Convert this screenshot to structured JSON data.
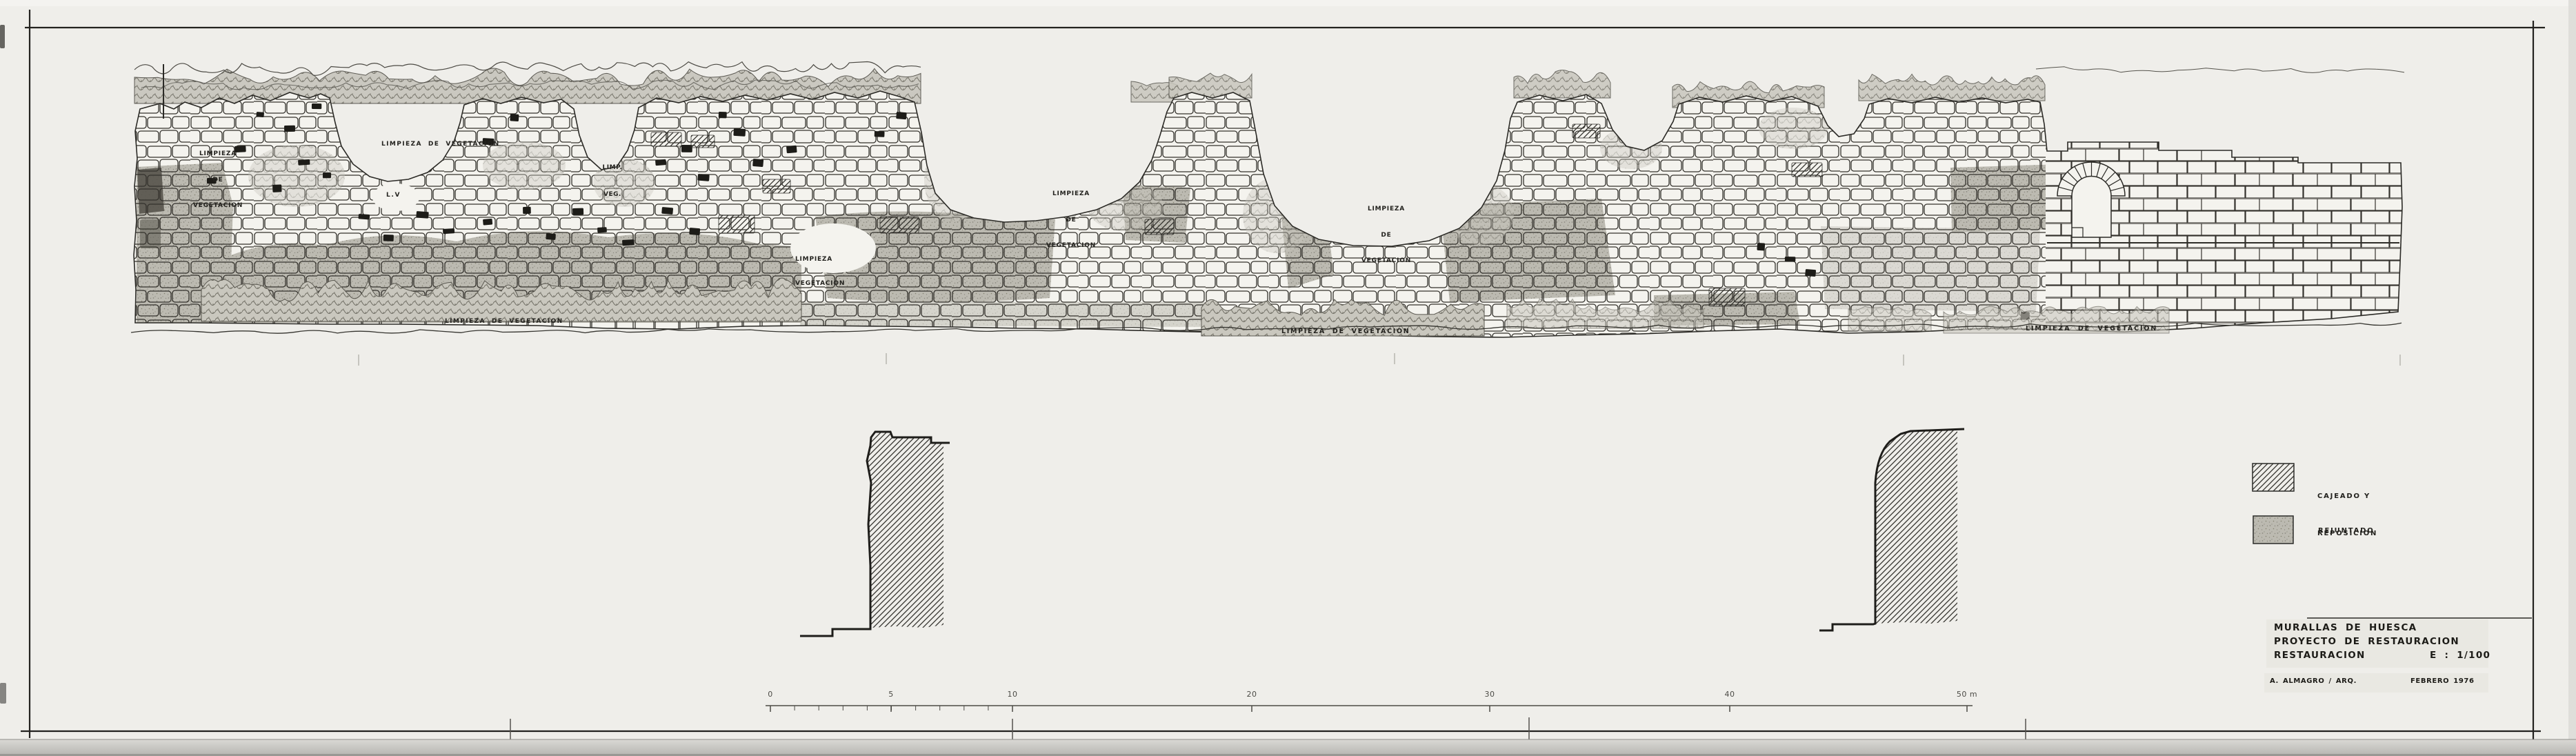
{
  "sheet": {
    "title_block": {
      "line1": "MURALLAS DE HUESCA",
      "line2": "PROYECTO DE RESTAURACION",
      "line3_label": "RESTAURACION",
      "line3_scale": "E : 1/100",
      "author": "A. ALMAGRO / ARQ.",
      "date": "FEBRERO 1976"
    },
    "legend": {
      "item1": {
        "line1": "CAJEADO Y",
        "line2": "REPOSICION",
        "pattern": "diagonal-hatch"
      },
      "item2": {
        "line1": "REJUNTADO",
        "pattern": "gray-stipple"
      }
    },
    "annotations": {
      "top_left": [
        "LIMPIEZA",
        "DE",
        "VEGETACION"
      ],
      "top_center_left": "LIMPIEZA  DE  VEGETACION",
      "top_abbrev": [
        "LIMP.",
        "VEG."
      ],
      "lv_abbrev": "L.V",
      "mid_left": [
        "LIMPIEZA",
        "VEGETACION"
      ],
      "mid_center": [
        "LIMPIEZA",
        "DE",
        "VEGETACION"
      ],
      "mid_right": [
        "LIMPIEZA",
        "DE",
        "VEGETACION"
      ],
      "ground_left": "LIMPIEZA  DE  VEGETACION",
      "ground_center": "LIMPIEZA  DE  VEGETACION",
      "ground_right": "LIMPIEZA  DE  VEGETACION"
    },
    "scale_bar": {
      "unit": "m",
      "tick_labels": [
        "0",
        "5",
        "10",
        "20",
        "30",
        "40",
        "50 m"
      ]
    },
    "colors": {
      "ink": "#2a2925",
      "paper": "#efeeea",
      "stipple_gray": "#bcbab1"
    }
  }
}
